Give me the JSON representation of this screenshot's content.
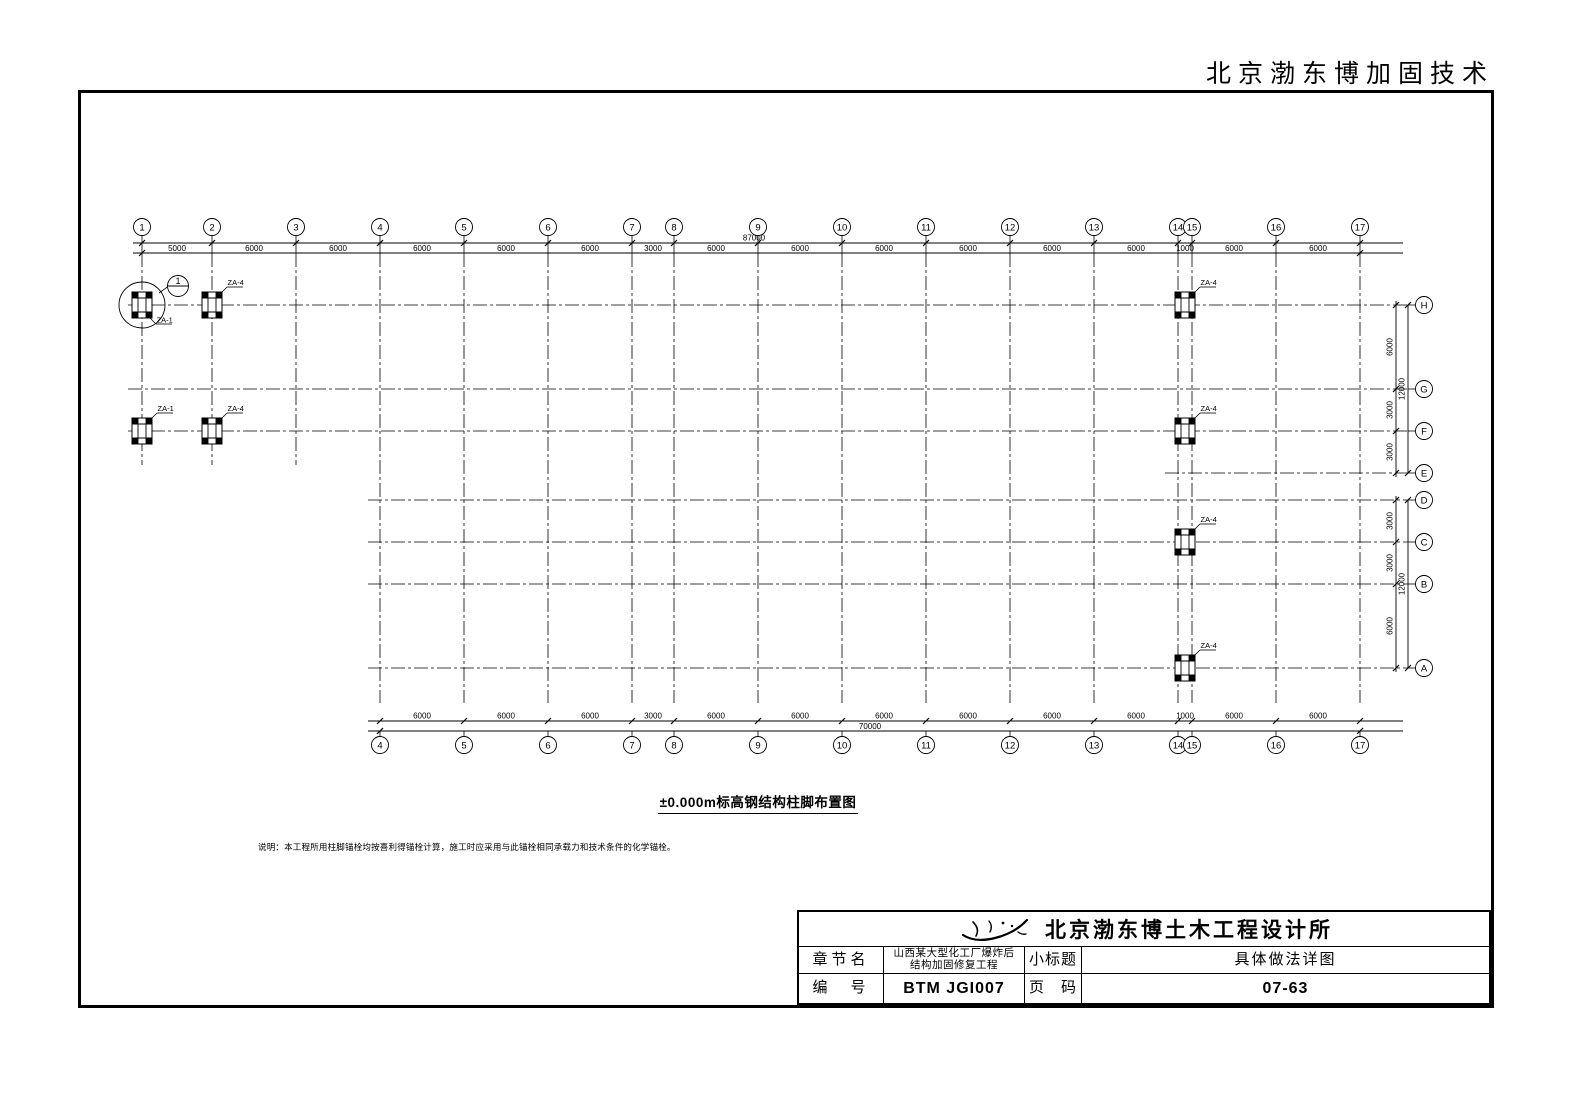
{
  "page_header": "北京渤东博加固技术",
  "colors": {
    "ink": "#000000",
    "paper": "#ffffff"
  },
  "drawing": {
    "title": "±0.000m标高钢结构柱脚布置图",
    "note": "说明：本工程所用柱脚锚栓均按喜利得锚栓计算，施工时应采用与此锚栓相同承载力和技术条件的化学锚栓。",
    "top_grid": {
      "labels": [
        "1",
        "2",
        "3",
        "4",
        "5",
        "6",
        "7",
        "8",
        "9",
        "10",
        "11",
        "12",
        "13",
        "14",
        "15",
        "16",
        "17"
      ],
      "spacings_mm": [
        5000,
        6000,
        6000,
        6000,
        6000,
        6000,
        3000,
        6000,
        6000,
        6000,
        6000,
        6000,
        6000,
        1000,
        6000,
        6000
      ],
      "total_mm": "87000"
    },
    "bottom_grid": {
      "labels": [
        "4",
        "5",
        "6",
        "7",
        "8",
        "9",
        "10",
        "11",
        "12",
        "13",
        "14",
        "15",
        "16",
        "17"
      ],
      "spacings_mm": [
        6000,
        6000,
        6000,
        3000,
        6000,
        6000,
        6000,
        6000,
        6000,
        6000,
        1000,
        6000,
        6000
      ],
      "total_mm": "70000"
    },
    "row_grid_upper": {
      "labels": [
        "H",
        "G",
        "F",
        "E"
      ],
      "spacings_mm": [
        6000,
        3000,
        3000
      ],
      "total_mm": "12000"
    },
    "row_grid_lower": {
      "labels": [
        "D",
        "C",
        "B",
        "A"
      ],
      "spacings_mm": [
        3000,
        3000,
        6000
      ],
      "total_mm": "12000"
    },
    "columns": [
      {
        "grid": "1",
        "row": "H",
        "label": "ZA-1",
        "label_pos": "br",
        "detail_circle": true
      },
      {
        "grid": "2",
        "row": "H",
        "label": "ZA-4"
      },
      {
        "grid": "1",
        "row": "F",
        "label": "ZA-1"
      },
      {
        "grid": "2",
        "row": "F",
        "label": "ZA-4"
      },
      {
        "grid": "14-15",
        "row": "H",
        "label": "ZA-4"
      },
      {
        "grid": "14-15",
        "row": "F",
        "label": "ZA-4"
      },
      {
        "grid": "14-15",
        "row": "C",
        "label": "ZA-4"
      },
      {
        "grid": "14-15",
        "row": "A",
        "label": "ZA-4"
      }
    ],
    "detail_callout": {
      "number": "1"
    }
  },
  "title_block": {
    "company": "北京渤东博土木工程设计所",
    "chapter_label": "章节名",
    "project_line1": "山西某大型化工厂爆炸后",
    "project_line2": "结构加固修复工程",
    "subtitle_label": "小标题",
    "subtitle_value": "具体做法详图",
    "number_label": "编　号",
    "number_value": "BTM JGI007",
    "page_label": "页　码",
    "page_value": "07-63"
  }
}
